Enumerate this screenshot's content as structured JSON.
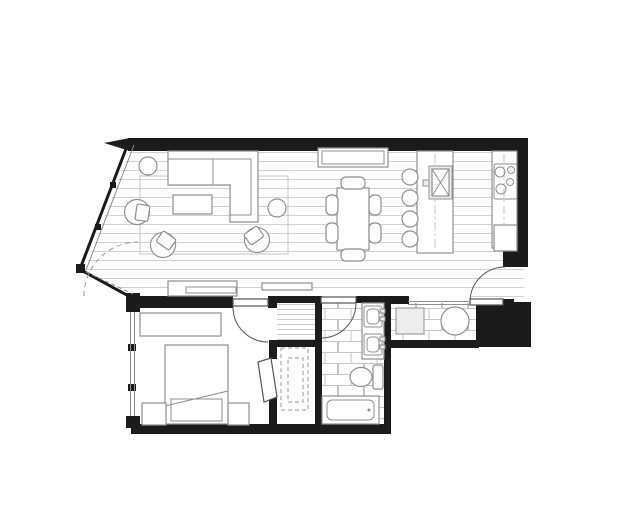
{
  "aria_label": "One-bedroom apartment floor plan drawing",
  "document": {
    "type": "architectural-floor-plan",
    "unit_type": "one-bedroom apartment",
    "text_labels": []
  },
  "colors": {
    "wall": "#1b1b1b",
    "furniture_line": "#8f8f8f",
    "floor_plank_line": "#d2d2d2",
    "tile_line": "#c6c6c6",
    "door_line": "#555555",
    "glass": "#8a8a8a",
    "background": "#ffffff"
  },
  "rooms": [
    {
      "name": "living-room",
      "floor": "wood-plank",
      "furniture": [
        "sectional-sofa-with-chaise",
        "coffee-table",
        "area-rug",
        "barrel-armchair-left",
        "barrel-armchair-bottom",
        "barrel-armchair-right",
        "round-side-table-left",
        "round-side-table-right",
        "media-console",
        "wall-shelf"
      ]
    },
    {
      "name": "dining-area",
      "floor": "wood-plank",
      "furniture": [
        "sideboard",
        "dining-table",
        "dining-chairs-x6"
      ]
    },
    {
      "name": "kitchen",
      "floor": "wood-plank",
      "fixtures": [
        "island-with-sink",
        "bar-stools-x4",
        "counter-with-cooktop",
        "cooktop-4-burners",
        "refrigerator-cabinet"
      ]
    },
    {
      "name": "bedroom",
      "floor": "plain",
      "furniture": [
        "dresser",
        "bed",
        "pillow-band",
        "nightstand-left",
        "nightstand-right",
        "window-wall-west"
      ]
    },
    {
      "name": "walk-in-closet",
      "floor": "plain",
      "fixtures": [
        "dashed-shelving-outer",
        "dashed-shelving-inner"
      ]
    },
    {
      "name": "bathroom",
      "floor": "ceramic-tile",
      "fixtures": [
        "vanity-counter",
        "sink-upper",
        "sink-lower",
        "toilet",
        "bathtub"
      ]
    },
    {
      "name": "laundry-closet",
      "floor": "ceramic-tile",
      "fixtures": [
        "washer",
        "dryer"
      ]
    },
    {
      "name": "entry",
      "floor": "wood-plank",
      "fixtures": [
        "entry-door"
      ]
    }
  ],
  "doors": [
    "entry-door",
    "bedroom-door",
    "bathroom-door",
    "closet-door-ajar",
    "balcony-door-swing-dashed"
  ],
  "windows": [
    "angled-glazed-wall-upper",
    "angled-glazed-wall-lower-sliding",
    "bedroom-west-window"
  ]
}
